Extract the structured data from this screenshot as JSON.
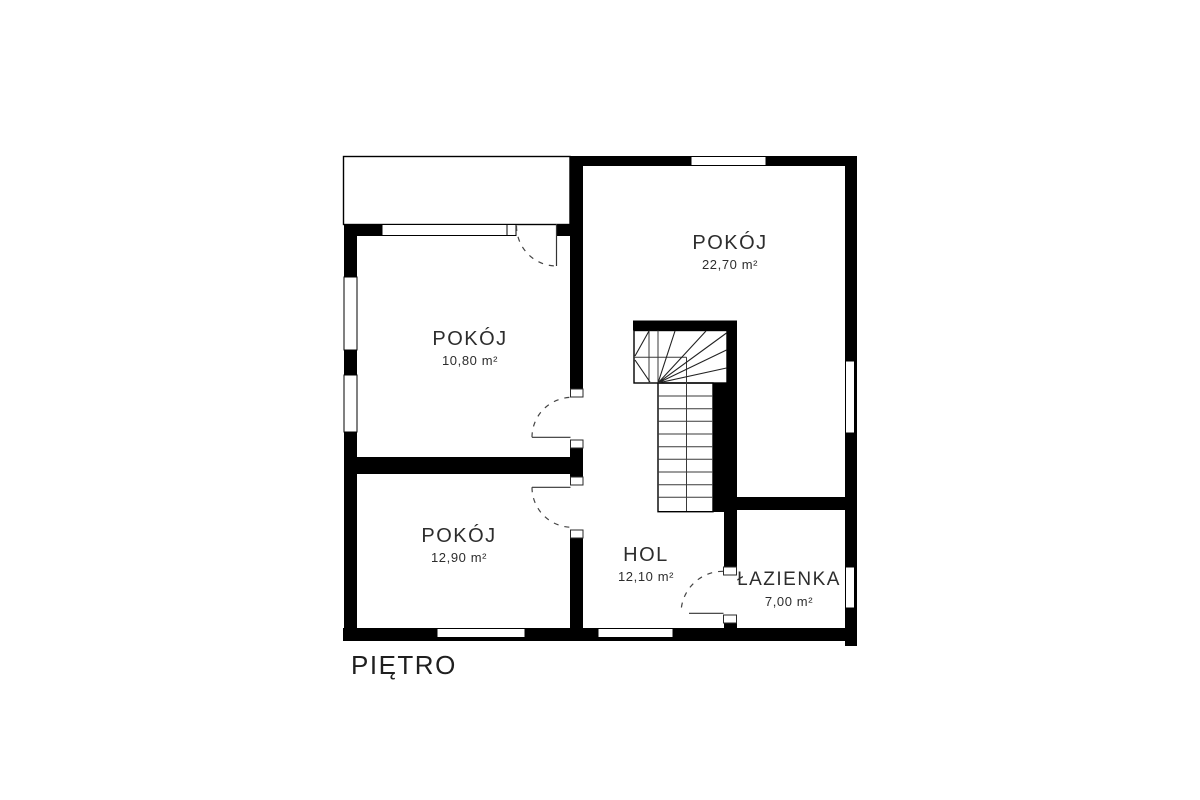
{
  "plan": {
    "floor_label": "PIĘTRO",
    "rooms": [
      {
        "id": "pokoj-top-right",
        "name": "POKÓJ",
        "area": "22,70 m²"
      },
      {
        "id": "pokoj-top-left",
        "name": "POKÓJ",
        "area": "10,80 m²"
      },
      {
        "id": "pokoj-bottom",
        "name": "POKÓJ",
        "area": "12,90 m²"
      },
      {
        "id": "hol",
        "name": "HOL",
        "area": "12,10 m²"
      },
      {
        "id": "lazienka",
        "name": "ŁAZIENKA",
        "area": "7,00 m²"
      }
    ],
    "colors": {
      "wall": "#000000",
      "text": "#2d2d2d",
      "background": "#ffffff"
    }
  }
}
